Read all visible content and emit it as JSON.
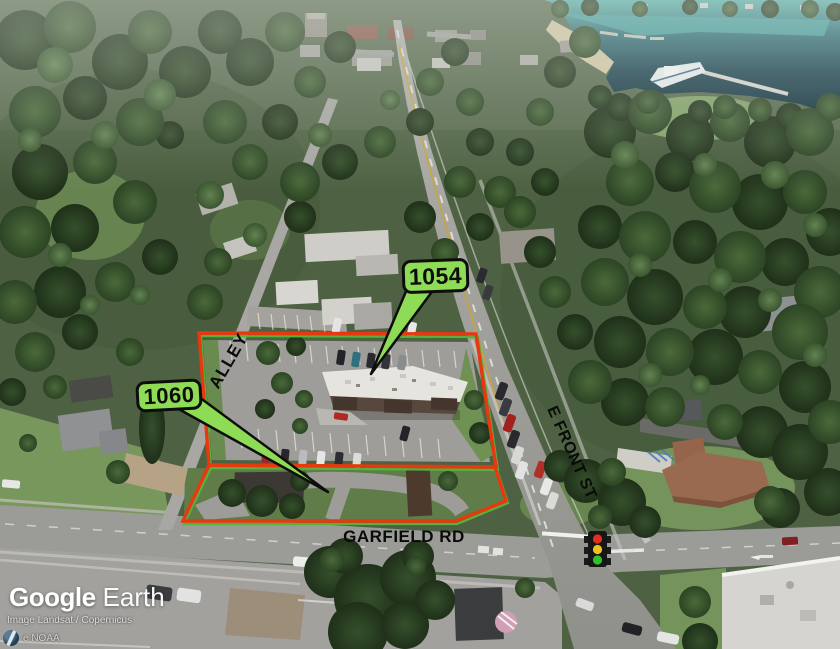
{
  "branding": {
    "logo_part1": "Google",
    "logo_part2": "Earth",
    "attribution_line1": "Image Landsat / Copernicus",
    "attribution_line2": "e NOAA"
  },
  "map": {
    "callouts": [
      {
        "id": "1054",
        "label": "1054"
      },
      {
        "id": "1060",
        "label": "1060"
      }
    ],
    "street_labels": {
      "alley": "ALLEY",
      "e_front_st": "E FRONT ST",
      "garfield_rd": "GARFIELD RD"
    },
    "icons": {
      "traffic_light": "traffic-light-icon",
      "attribution_globe": "globe-logo-icon"
    },
    "colors": {
      "parcel_outline": "#E8380F",
      "parcel_underlay": "#55B33C",
      "callout_fill": "#8EDB55",
      "water_deep": "#12303C",
      "water_shallow": "#5FBDB8"
    }
  }
}
